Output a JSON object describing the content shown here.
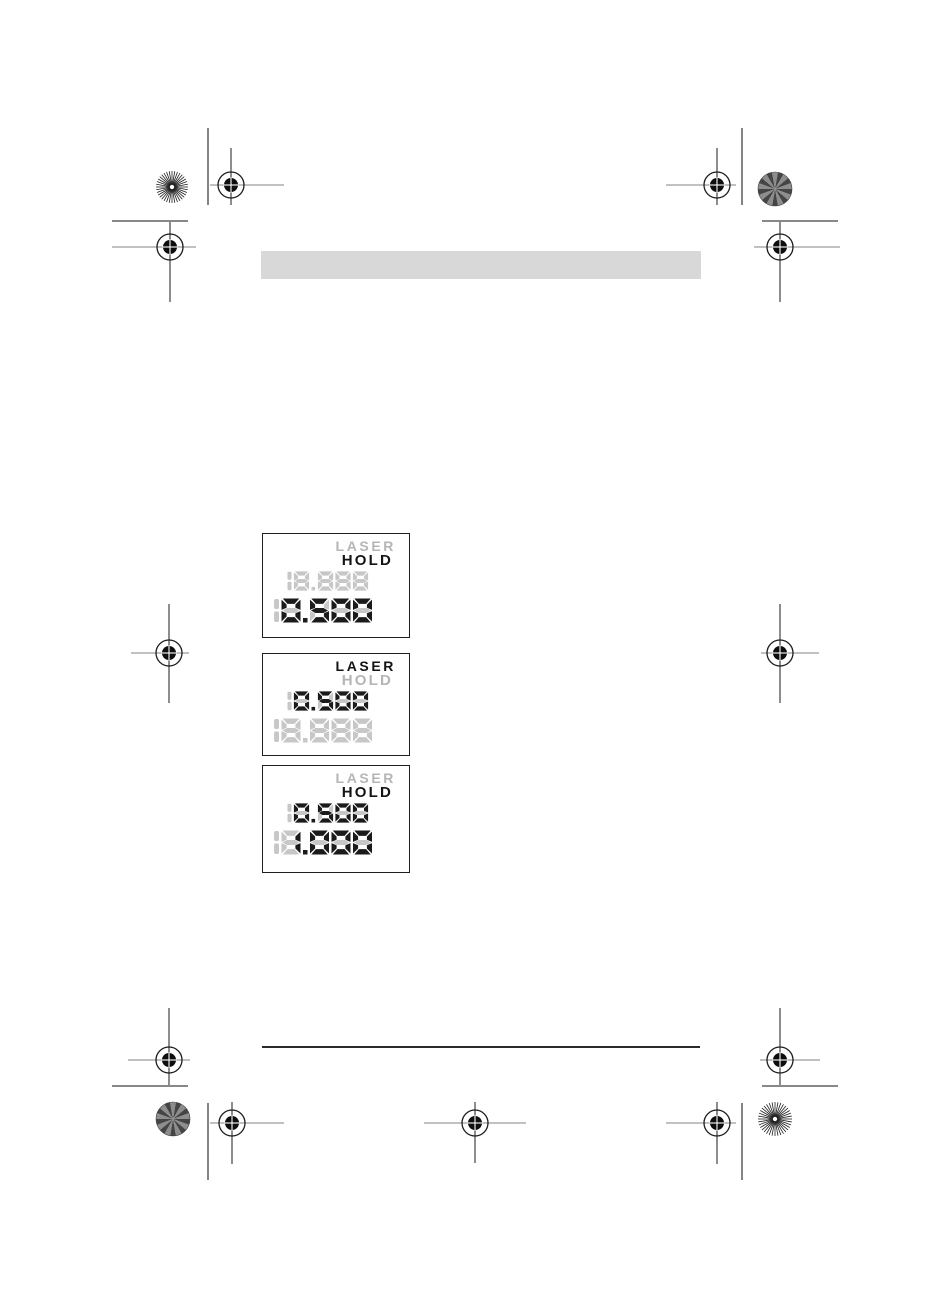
{
  "document": {
    "kind": "printed manual page",
    "header_bar_text": ""
  },
  "lcd_displays": [
    {
      "indicators": [
        {
          "label": "LASER",
          "active": false
        },
        {
          "label": "HOLD",
          "active": true
        }
      ],
      "rows": [
        {
          "ghost_prefix": "1",
          "value": "8.888",
          "unit": "m",
          "lit": false,
          "size": "small"
        },
        {
          "ghost_prefix": "1",
          "value": "0.500",
          "unit": "m",
          "lit": true,
          "size": "large"
        }
      ]
    },
    {
      "indicators": [
        {
          "label": "LASER",
          "active": true
        },
        {
          "label": "HOLD",
          "active": false
        }
      ],
      "rows": [
        {
          "ghost_prefix": "1",
          "value": "0.500",
          "unit": "m",
          "lit": true,
          "size": "small"
        },
        {
          "ghost_prefix": "1",
          "value": "8.888",
          "unit": "m",
          "lit": false,
          "size": "large"
        }
      ]
    },
    {
      "indicators": [
        {
          "label": "LASER",
          "active": false
        },
        {
          "label": "HOLD",
          "active": true
        }
      ],
      "rows": [
        {
          "ghost_prefix": "1",
          "value": "0.500",
          "unit": "m",
          "lit": true,
          "size": "small"
        },
        {
          "ghost_prefix": "1",
          "value": "1.000",
          "unit": "m",
          "lit": true,
          "size": "large"
        }
      ]
    }
  ],
  "colors": {
    "segment_lit": "#1b1b1b",
    "segment_ghost": "#c7c7c7",
    "indicator_active": "#141414",
    "indicator_inactive": "#b5b5b5",
    "lcd_border": "#1f1f1f",
    "header_bar": "#d8d8d8",
    "footer_rule": "#2b2b2b",
    "crop_line": "#414141",
    "mark_horizontal_line": "#9c9c9c",
    "mark_circle": "#1c1c1c",
    "mark_disc": "#0e0e0e",
    "star_dark_a": "#454545",
    "star_dark_b": "#8d8d8d",
    "star_light": "#1e1e1e"
  }
}
